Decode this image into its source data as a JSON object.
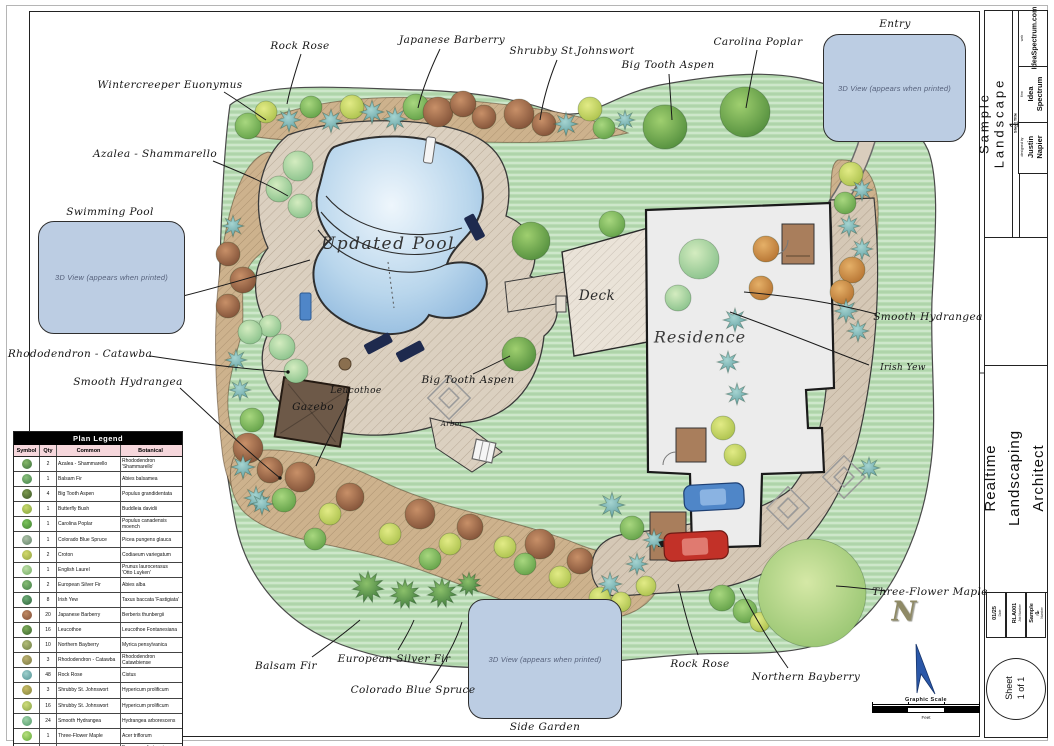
{
  "plan": {
    "labels": {
      "rock_rose_top": "Rock Rose",
      "japanese_barberry": "Japanese Barberry",
      "shrubby_st_johnswort": "Shrubby St.Johnswort",
      "big_tooth_aspen_top": "Big Tooth Aspen",
      "carolina_poplar": "Carolina Poplar",
      "entry": "Entry",
      "wintercreeper_euonymus": "Wintercreeper Euonymus",
      "azalea_shammarello": "Azalea - Shammarello",
      "swimming_pool": "Swimming Pool",
      "rhododendron_catawba": "Rhododendron - Catawba",
      "smooth_hydrangea_left": "Smooth Hydrangea",
      "updated_pool": "Updated Pool",
      "leucothoe": "Leucothoe",
      "gazebo": "Gazebo",
      "big_tooth_aspen_mid": "Big Tooth Aspen",
      "arbor": "Arbor",
      "deck": "Deck",
      "residence": "Residence",
      "smooth_hydrangea_right": "Smooth Hydrangea",
      "irish_yew": "Irish Yew",
      "three_flower_maple": "Three-Flower Maple",
      "northern_bayberry": "Northern Bayberry",
      "rock_rose_bottom": "Rock Rose",
      "balsam_fir": "Balsam Fir",
      "european_silver_fir": "European Silver Fir",
      "colorado_blue_spruce": "Colorado Blue Spruce",
      "side_garden": "Side Garden"
    },
    "viewport_placeholder": "3D View (appears when printed)",
    "north_letter": "N",
    "scale": {
      "title": "Graphic Scale",
      "unit": "Feet"
    },
    "colors": {
      "lawn": "#b9dcb4",
      "water": "#8cb6dc",
      "viewport_fill": "#bccde3",
      "blue_car": "#4f86c8",
      "red_car": "#c23128"
    }
  },
  "legend": {
    "title": "Plan Legend",
    "columns": [
      "Symbol",
      "Qty",
      "Common",
      "Botanical"
    ],
    "rows": [
      {
        "qty": "2",
        "common": "Azalea - Shammarello",
        "botanical": "Rhododendron 'Shammarello'",
        "colors": [
          "#86b869",
          "#3c6e3c"
        ]
      },
      {
        "qty": "1",
        "common": "Balsam Fir",
        "botanical": "Abies balsamea",
        "colors": [
          "#8cc27c",
          "#3f7d4a"
        ]
      },
      {
        "qty": "4",
        "common": "Big Tooth Aspen",
        "botanical": "Populus grandidentata",
        "colors": [
          "#7d9a4e",
          "#3a5526"
        ]
      },
      {
        "qty": "1",
        "common": "Butterfly Bush",
        "botanical": "Buddleia davidii",
        "colors": [
          "#c9da6e",
          "#7fa03a"
        ]
      },
      {
        "qty": "1",
        "common": "Carolina Poplar",
        "botanical": "Populus canadensis moench",
        "colors": [
          "#7cc45c",
          "#3f8030"
        ]
      },
      {
        "qty": "1",
        "common": "Colorado Blue Spruce",
        "botanical": "Picea pungens glauca",
        "colors": [
          "#aec2a8",
          "#5f8068"
        ]
      },
      {
        "qty": "2",
        "common": "Croton",
        "botanical": "Codiaeum variegatum",
        "colors": [
          "#d3d96a",
          "#8fa040"
        ]
      },
      {
        "qty": "1",
        "common": "English Laurel",
        "botanical": "Prunus laurocerasus 'Otto Luyken'",
        "colors": [
          "#bfe0a8",
          "#6fa860"
        ]
      },
      {
        "qty": "2",
        "common": "European Silver Fir",
        "botanical": "Abies alba",
        "colors": [
          "#86bd74",
          "#3f7a45"
        ]
      },
      {
        "qty": "8",
        "common": "Irish Yew",
        "botanical": "Taxus baccata 'Fastigiata'",
        "colors": [
          "#6fae77",
          "#2a5f3a"
        ]
      },
      {
        "qty": "20",
        "common": "Japanese Barberry",
        "botanical": "Berberis thunbergii",
        "colors": [
          "#c08a63",
          "#7d4a35"
        ]
      },
      {
        "qty": "16",
        "common": "Leucothoe",
        "botanical": "Leucothoe Fontanesiana",
        "colors": [
          "#7fae5a",
          "#365f2c"
        ]
      },
      {
        "qty": "10",
        "common": "Northern Bayberry",
        "botanical": "Myrica pensylvanica",
        "colors": [
          "#b3bd78",
          "#6a7a42"
        ]
      },
      {
        "qty": "3",
        "common": "Rhododendron - Catawba",
        "botanical": "Rhododendron Catawbiense",
        "colors": [
          "#bdb272",
          "#77763f"
        ]
      },
      {
        "qty": "48",
        "common": "Rock Rose",
        "botanical": "Cistus",
        "colors": [
          "#9fd0cd",
          "#4e8f92"
        ]
      },
      {
        "qty": "3",
        "common": "Shrubby St. Johnswort",
        "botanical": "Hypericum prolificum",
        "colors": [
          "#c9bd66",
          "#7f7f3a"
        ]
      },
      {
        "qty": "16",
        "common": "Shrubby St. Johnswort",
        "botanical": "Hypericum prolificum",
        "colors": [
          "#cfdd7a",
          "#85a045"
        ]
      },
      {
        "qty": "24",
        "common": "Smooth Hydrangea",
        "botanical": "Hydrangea arborescens",
        "colors": [
          "#9fd4a8",
          "#4f9668"
        ]
      },
      {
        "qty": "1",
        "common": "Three-Flower Maple",
        "botanical": "Acer triflorum",
        "colors": [
          "#b8e07f",
          "#5fa838"
        ]
      },
      {
        "qty": "21",
        "common": "Wintercreeper Euonymus",
        "botanical": "Euonymus fortunei 'Emerald n Gold'",
        "colors": [
          "#c6d870",
          "#6f9f3c"
        ]
      }
    ]
  },
  "title_block": {
    "sheet_title_label": "Sheet Title",
    "sheet_title": "Sample Landscape 1",
    "designed_by_label": "designed by",
    "designed_by": "Justin Napier",
    "firm_label": "firm",
    "firm": "Idea Spectrum",
    "web_label": "web",
    "web": "IdeaSpectrum.com",
    "product": "Realtime Landscaping\nArchitect",
    "date_label": "Date",
    "date": "01/25",
    "job_label": "Job Number",
    "job": "RLA001",
    "file_label": "File Number",
    "file": "Sample 1",
    "sheet_circle": "Sheet\n1 of 1"
  }
}
